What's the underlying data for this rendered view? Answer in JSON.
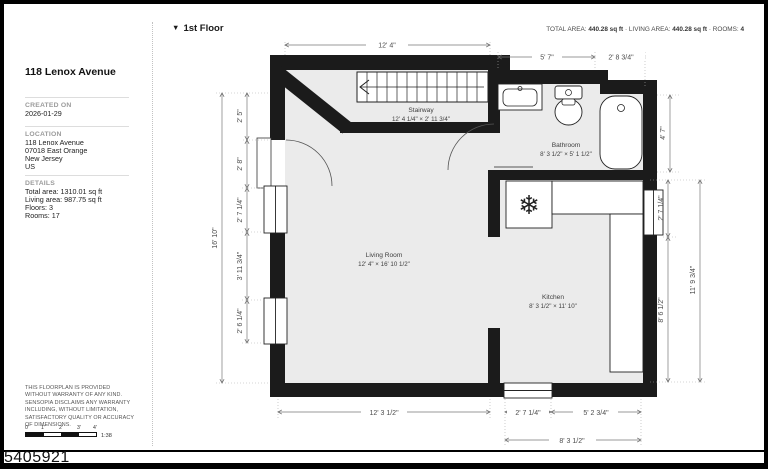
{
  "icons": {
    "collapse": "▼",
    "refrigerator": "❄",
    "stair_direction": "left-arrow"
  },
  "photo_id": "5405921",
  "sidebar": {
    "title": "118 Lenox Avenue",
    "created_on_label": "CREATED ON",
    "created_on_value": "2026-01-29",
    "location_label": "LOCATION",
    "location_value": "118 Lenox Avenue\n07018 East Orange\nNew Jersey\nUS",
    "details_label": "DETAILS",
    "details_value": "Total area: 1310.01 sq ft\nLiving area: 987.75 sq ft\nFloors: 3\nRooms: 17",
    "disclaimer": "This floorplan is provided without warranty of any kind. Sensopia disclaims any warranty including, without limitation, satisfactory quality or accuracy of dimensions.",
    "scale": {
      "ticks": [
        "0'",
        "1'",
        "2'",
        "3'",
        "4'"
      ],
      "ratio": "1:38"
    }
  },
  "header": {
    "floor_label": "1st Floor",
    "total_area_label": "TOTAL AREA:",
    "total_area_value": "440.28 sq ft",
    "living_area_label": "LIVING AREA:",
    "living_area_value": "440.28 sq ft",
    "rooms_label": "ROOMS:",
    "rooms_value": "4",
    "sep": "·"
  },
  "plan": {
    "rooms": {
      "stairway": {
        "name": "Stairway",
        "size": "12' 4 1/4\" × 2' 11 3/4\""
      },
      "bathroom": {
        "name": "Bathroom",
        "size": "8' 3 1/2\" × 5' 1 1/2\""
      },
      "kitchen": {
        "name": "Kitchen",
        "size": "8' 3 1/2\" × 11' 10\""
      },
      "living_room": {
        "name": "Living Room",
        "size": "12' 4\" × 16' 10 1/2\""
      }
    },
    "dims": {
      "top": [
        "12' 4\"",
        "5' 7\"",
        "2' 8 3/4\""
      ],
      "left": [
        "2' 5\"",
        "2' 8\"",
        "2' 7 1/4\"",
        "3' 11 3/4\"",
        "2' 6 1/4\""
      ],
      "left_total": "16' 10\"",
      "right": [
        "4' 7\"",
        "2' 7 1/4\"",
        "8' 6 1/2\""
      ],
      "right_total": "11' 9 3/4\"",
      "bottom": [
        "12' 3 1/2\"",
        "2' 7 1/4\"",
        "5' 2 3/4\""
      ],
      "bottom_total": "8' 3 1/2\""
    },
    "colors": {
      "wall": "#1b1b1b",
      "floor": "#ebebeb",
      "dim_line": "#777777",
      "dim_text": "#4c4c4c"
    }
  }
}
